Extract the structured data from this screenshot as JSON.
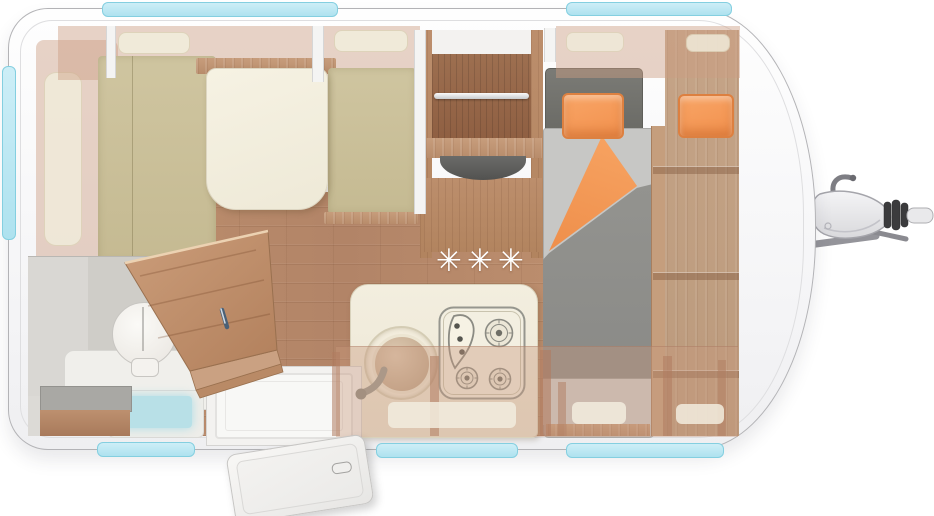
{
  "meta": {
    "title": "Caravan floor plan — top view"
  },
  "heater": {
    "label": "Heater position",
    "symbols": [
      "✳",
      "✳",
      "✳"
    ]
  },
  "areas": {
    "shell": "Caravan body",
    "dinette": "Dinette seating group with table",
    "table": "Dinette table",
    "seat": "Upholstered bench seat",
    "overhead_locker": "Overhead locker",
    "wardrobe": "Wardrobe with hanging rail",
    "rail": "Wardrobe hanging rail",
    "kitchen": "Kitchen block",
    "sink": "Kitchen sink with tap",
    "hob": "3-burner gas hob",
    "bathroom": "Washroom",
    "toilet": "Toilet",
    "shower": "Shower tray",
    "step": "Step / storage box",
    "bathroom_door": "Washroom door (open)",
    "entrance": "Entrance door area",
    "entrance_door": "Entrance door (shown open)",
    "bed": "Single bed with duvet",
    "pillow": "Pillow",
    "duvet": "Duvet (folded back)",
    "headboard": "Bed head section",
    "side_cabinet": "Bedside wardrobe / shelves",
    "window": "Window",
    "hitch": "Tow hitch / drawbar",
    "floor": "Wood floor"
  },
  "colors": {
    "window_teal": "#aee2ef",
    "floor_wood": "#b98c6c",
    "furniture_wood": "#c0977a",
    "wardrobe_wood": "#9a6b4d",
    "cushion_khaki": "#cbc19b",
    "counter_cream": "#f0ebdc",
    "mattress_gray": "#c7c7c5",
    "duvet_gray": "#8f8f8c",
    "headboard_gray": "#73736e",
    "pillow_orange": "#f69b5d",
    "body_white": "#fdfdfd"
  }
}
